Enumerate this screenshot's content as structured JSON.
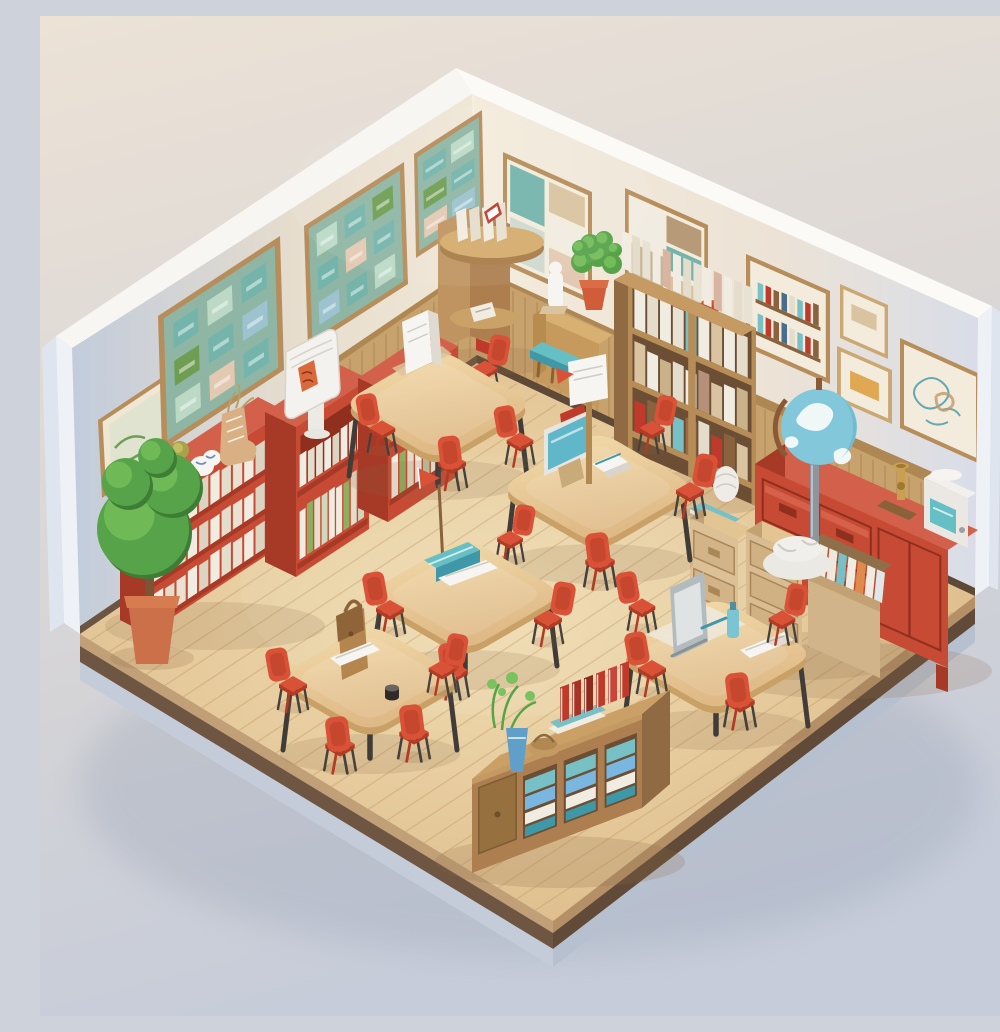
{
  "image": {
    "kind": "3D isometric illustration",
    "subject": "Miniature cutaway classroom and school library diorama",
    "description": "An isometric cutaway room on a floating wooden slab. Two walls (pale blue-grey left, cream right) hold framed green bulletin boards, collage posters and a sketch. Along the walls: red bookcases full of white books, a white flip-chart display, a topiary tree in a terracotta pot, a corner reading nook, a narrow console with a potted plant, a teal step stool, a tall stuffed wooden bookshelf, a red sideboard with a standing globe, brass trophy and a small teal machine, and wooden file pedestals with folders. Five light-wood student tables with small red plastic chairs fill the floor, topped with a reading stand, a teal monitor, a banner pole, a pennant flag, books, a satchel and a laptop screen. A low wooden book console with teal books, red books, a blue vase plant and a basket sits at the front edge.",
    "contains_text": false
  },
  "palette": {
    "bgTop": "#ece2d6",
    "bgMid": "#dcd8d6",
    "bgBottom": "#c6ccd9",
    "shadowBlue": "#97a1b4",
    "wallLeftFar": "#c2ccdc",
    "wallLeftNear": "#f0e7d7",
    "wallRightNear": "#f4ebdb",
    "wallRightFar": "#d9dde8",
    "wallTop": "#f8f6f3",
    "wallCap": "#eef1f6",
    "wallCapSide": "#dfe5ee",
    "wainscot": "#c7a26d",
    "wainscotLine": "#aa8450",
    "rail": "#ae8752",
    "baseboard": "#6b5540",
    "floorLight": "#f0ddb2",
    "floorWarm": "#d8b27f",
    "plankLine": "#c6a06e",
    "edgeTan": "#c2a077",
    "slabDark": "#6e5642",
    "plinth": "#c5ccd9",
    "woodLight": "#e3c493",
    "wood": "#c49a62",
    "woodDark": "#a97f4d",
    "woodSide": "#8f6a42",
    "woodDeep": "#8a6239",
    "shelfBoard": "#b68c57",
    "shelfInterior": "#6b4e33",
    "tableTopA": "#f2dcab",
    "tableTopB": "#dfb986",
    "tableEdge": "#c9a166",
    "tableLeg": "#413c37",
    "red": "#c74b34",
    "redTop": "#d2604a",
    "redSide": "#a63a26",
    "redDeep": "#8f2f1d",
    "chairRed": "#d95237",
    "chairRedDark": "#b13b25",
    "chairLeg": "#46413c",
    "bookWhite": "#f1ece1",
    "bookCream": "#e5ddcc",
    "bookTeal": "#76c0c6",
    "bookBlue": "#79b7e0",
    "bookRed": "#bf3a2b",
    "bookGreen": "#8fae5f",
    "paperTan": "#d9c3a0",
    "boardGreen": "#8fb6a4",
    "cardTeal": "#74b4ab",
    "cardGreen": "#6f9e53",
    "cardMint": "#bcd9c6",
    "cardPink": "#e3c9b2",
    "cardBlue": "#9cc3cf",
    "frame": "#b68d5b",
    "frameLight": "#cba873",
    "mat": "#efe7d4",
    "paper": "#f3ecdc",
    "plantGreen": "#57a349",
    "plantDark": "#3e7d35",
    "plantLight": "#79c25e",
    "terracotta": "#cb7048",
    "potRed": "#d05c39",
    "globeOcean": "#82c7da",
    "globeLand": "#eff7f7",
    "globeRing": "#8a5a36",
    "globeShade": "#58a7bf",
    "polePewter": "#8e959c",
    "plaster": "#ebe9e4",
    "teal": "#66bfc4",
    "tealDeep": "#3f98a8",
    "laptop": "#b4bbbf",
    "laptopLight": "#dfe3e4",
    "white": "#f7f5f1",
    "brass": "#c9a050",
    "brassDark": "#a07830",
    "bagTan": "#b5854e",
    "bagDark": "#8f6439",
    "vaseBlue": "#5f9fc9",
    "basket": "#c59a62",
    "inkBlack": "#2f2b28",
    "floorShadow": "#8a6a48"
  },
  "scene": {
    "room": {
      "view": "isometric cutaway, two walls and floating floor slab",
      "floor": "light wood planks over dark slab with pale blue plinth",
      "left_wall_color_ref": "wallLeftFar to wallLeftNear",
      "right_wall_color_ref": "wallRightNear to wallRightFar"
    },
    "wall_decor": [
      {
        "name": "small-framed-print",
        "wall": "left",
        "description": "small botanical sketch in wood frame"
      },
      {
        "name": "bulletin-board-1",
        "wall": "left",
        "description": "framed green bulletin board, 3x3 pinned cards"
      },
      {
        "name": "bulletin-board-2",
        "wall": "left",
        "description": "framed green bulletin board, 3x3 pinned cards"
      },
      {
        "name": "bulletin-board-3",
        "wall": "left",
        "description": "framed green bulletin board, partly hidden by corner nook"
      },
      {
        "name": "poster-collage-1",
        "wall": "right",
        "description": "framed collage poster, teal and tan cards"
      },
      {
        "name": "poster-collage-2",
        "wall": "right",
        "description": "framed collage poster, brown and cream cards"
      },
      {
        "name": "poster-books",
        "wall": "right",
        "description": "framed poster of book spines on shelves"
      },
      {
        "name": "small-frame-stack",
        "wall": "right",
        "description": "two small stacked frames"
      },
      {
        "name": "sketch-frame",
        "wall": "right",
        "description": "framed teal and tan abstract sketch"
      },
      {
        "name": "picture-rail",
        "wall": "right",
        "description": "wooden rail strip"
      },
      {
        "name": "wainscoting",
        "wall": "both",
        "description": "vertical wood panelling along wall bases"
      }
    ],
    "furniture": [
      {
        "name": "corner-reading-nook",
        "description": "wooden corner unit with round shelf of white books and an open red book"
      },
      {
        "name": "plant-console",
        "description": "narrow wooden console with white figurine and bushy plant in red pot"
      },
      {
        "name": "step-stool",
        "description": "small wooden stool with teal cushion"
      },
      {
        "name": "tall-bookshelf",
        "description": "double wooden bookshelf stuffed with white books, papers and boxes, books stacked on top"
      },
      {
        "name": "red-sideboard",
        "description": "long red credenza with drawers, brass trophy and small white-teal machine on top"
      },
      {
        "name": "globe",
        "description": "standing world globe, blue ocean, white land, brown meridian ring, grey pole, white plaster base"
      },
      {
        "name": "file-pedestals",
        "description": "light-wood drawer pedestals and an open file box with white, teal and orange folders"
      },
      {
        "name": "red-bookcase-a",
        "description": "low red bookcase with three rows of white books; pot plant, blue-white ornament and boot vase on top"
      },
      {
        "name": "red-bookcase-b",
        "description": "red display cabinet with white flip-chart display stand on top"
      },
      {
        "name": "red-bookcase-c",
        "description": "red open bookcase with white and green books"
      },
      {
        "name": "topiary-plant",
        "description": "round topiary tree in terracotta pot"
      },
      {
        "name": "book-console",
        "description": "low wooden console with three cubbies of teal books, standing red books, blue vase plant and basket"
      }
    ],
    "tables": [
      {
        "id": 1,
        "position": "back-left",
        "items": [
          "white reading stand"
        ],
        "chairs": 3
      },
      {
        "id": 2,
        "position": "center",
        "items": [
          "teal desktop monitor",
          "open book",
          "red folder",
          "wooden banner pole with white cards and red pennant"
        ],
        "chairs": 4
      },
      {
        "id": 3,
        "position": "center-left",
        "items": [
          "red pennant flag on stick",
          "teal pencil box",
          "open notebook"
        ],
        "chairs": 4
      },
      {
        "id": 4,
        "position": "front-left",
        "items": [
          "brown satchel bag",
          "notebook",
          "black inkwell"
        ],
        "chairs": 4
      },
      {
        "id": 5,
        "position": "front-right",
        "items": [
          "grey laptop screen",
          "teal bottle",
          "notebook on mat"
        ],
        "chairs": 4
      }
    ],
    "chairs": {
      "count": 20,
      "style": "small red-orange plastic school chairs, dark splayed legs"
    }
  }
}
